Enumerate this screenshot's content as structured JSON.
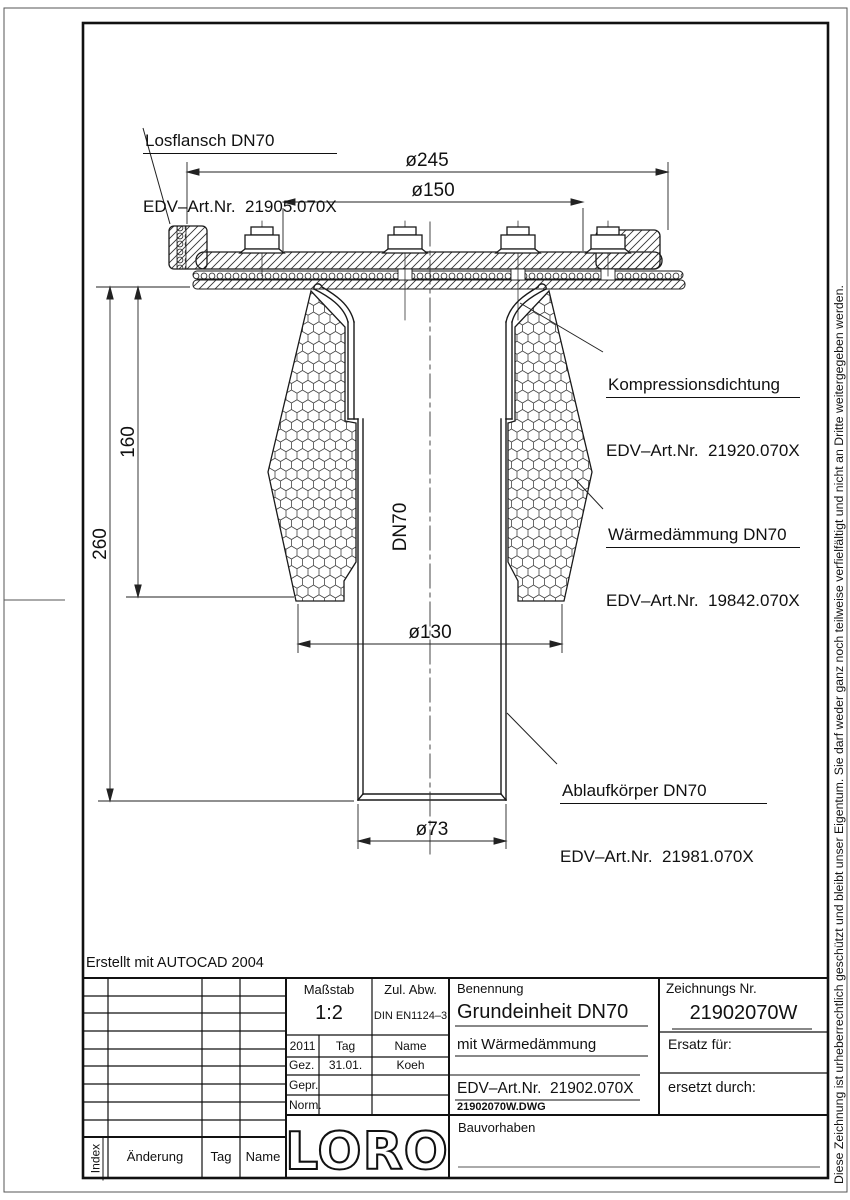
{
  "page": {
    "created_with": "Erstellt mit AUTOCAD 2004",
    "copyright_vertical": "Diese Zeichnung ist urheberrechtlich geschützt und bleibt unser Eigentum. Sie darf weder ganz noch teilweise verfielfältigt und nicht an Dritte weitergegeben werden."
  },
  "drawing": {
    "dimensions": {
      "d245": "ø245",
      "d150": "ø150",
      "d130": "ø130",
      "d73": "ø73",
      "h160": "160",
      "h260": "260",
      "pipe_label": "DN70"
    },
    "callouts": {
      "losflansch": {
        "line1": "Losflansch DN70",
        "line2": "EDV–Art.Nr.  21905.070X"
      },
      "kompressionsdichtung": {
        "line1": "Kompressionsdichtung",
        "line2": "EDV–Art.Nr.  21920.070X"
      },
      "waermedaemmung": {
        "line1": "Wärmedämmung DN70",
        "line2": "EDV–Art.Nr.  19842.070X"
      },
      "ablaufkoerper": {
        "line1": "Ablaufkörper DN70",
        "line2": "EDV–Art.Nr.  21981.070X"
      }
    }
  },
  "title_block": {
    "massstab_label": "Maßstab",
    "massstab_value": "1:2",
    "zul_abw_label": "Zul. Abw.",
    "zul_abw_value": "DIN EN1124–3",
    "benennung_label": "Benennung",
    "benennung_value": "Grundeinheit DN70",
    "subtitle": "mit Wärmedämmung",
    "edv_art": "EDV–Art.Nr.  21902.070X",
    "dwg_file": "21902070W.DWG",
    "zeichnungs_nr_label": "Zeichnungs Nr.",
    "zeichnungs_nr_value": "21902070W",
    "ersatz_fuer": "Ersatz für:",
    "ersetzt_durch": "ersetzt durch:",
    "bauvorhaben": "Bauvorhaben",
    "logo": "LORO",
    "approval": {
      "year": "2011",
      "tag": "Tag",
      "name": "Name",
      "gez": "Gez.",
      "gez_tag": "31.01.",
      "gez_name": "Koeh",
      "gepr": "Gepr.",
      "norm": "Norm."
    },
    "revision": {
      "index": "Index",
      "aenderung": "Änderung",
      "tag": "Tag",
      "name": "Name"
    }
  }
}
